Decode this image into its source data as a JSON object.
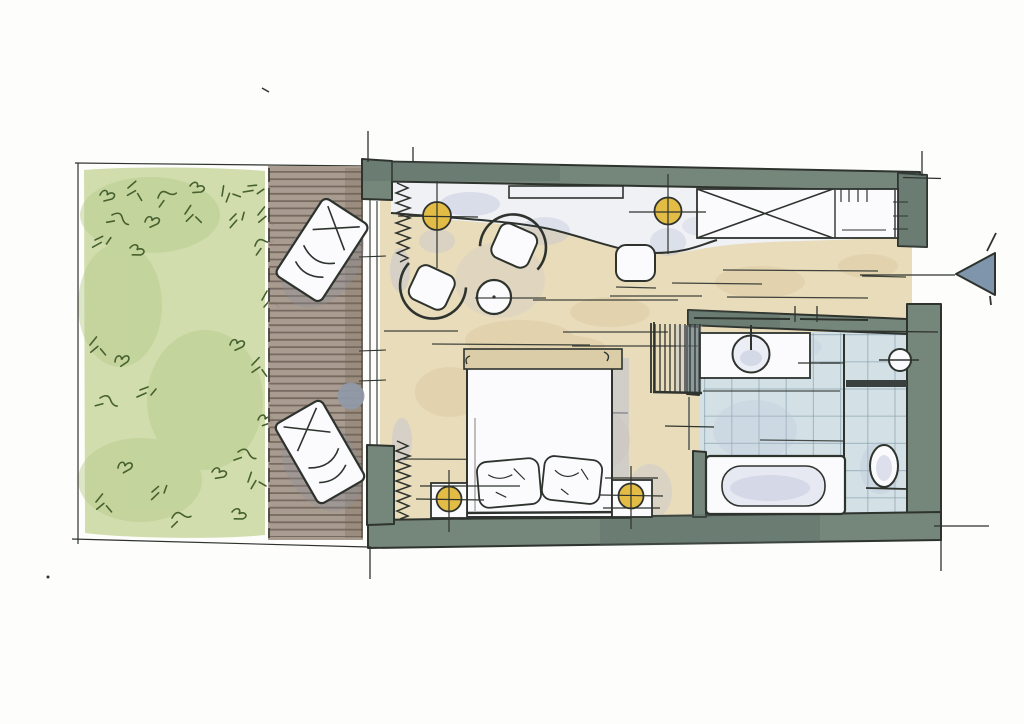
{
  "meta": {
    "type": "floor-plan-sketch",
    "style": "hand-drawn-watercolor",
    "text_visible": ""
  },
  "colors": {
    "paper": "#fdfdfb",
    "ink": "#2e332e",
    "wall_green": "#75867b",
    "wall_green_dark": "#5a6b61",
    "garden_green": "#ccd9a4",
    "garden_dark": "#a9c07e",
    "garden_stroke": "#46602f",
    "deck_wood": "#a3968a",
    "deck_stripe": "#6c5f54",
    "carpet_beige": "#e9dcbb",
    "carpet_blotch": "#d5c193",
    "entry_floor": "#eff1f5",
    "lavender_shadow": "#b9bfd6",
    "gray_shadow": "#97a0b2",
    "tile_blue": "#d3e1e6",
    "tile_grid": "#7f97a3",
    "fixture_white": "#fbfbfd",
    "lamp_yellow": "#e3bc45",
    "arrow_blue": "#7e95ab",
    "side_table_gray": "#8f9aa8",
    "dark_partition": "#3a403d"
  },
  "features": {
    "outdoor": [
      "garden-lawn",
      "wooden-deck",
      "sun-lounger",
      "sun-lounger",
      "deck-side-table"
    ],
    "living": [
      "curtain",
      "ceiling-light",
      "armchair",
      "armchair",
      "coffee-table",
      "stool",
      "wall-console",
      "wardrobe-crossed",
      "luggage-rack"
    ],
    "sleeping": [
      "double-bed",
      "pillow",
      "pillow",
      "nightstand",
      "nightstand",
      "bedside-lamp",
      "bedside-lamp",
      "slatted-screen",
      "curtain"
    ],
    "bathroom": [
      "vanity-basin",
      "walk-in-shower-tiles",
      "bathtub",
      "toilet",
      "hand-basin",
      "glass-partition"
    ],
    "annotations": [
      "entrance-arrow",
      "extension-lines",
      "door-opening"
    ]
  },
  "counts": {
    "sun_loungers": 2,
    "armchairs": 2,
    "ceiling_lights": 2,
    "bedside_lamps": 2,
    "pillows": 2,
    "nightstands": 2
  }
}
